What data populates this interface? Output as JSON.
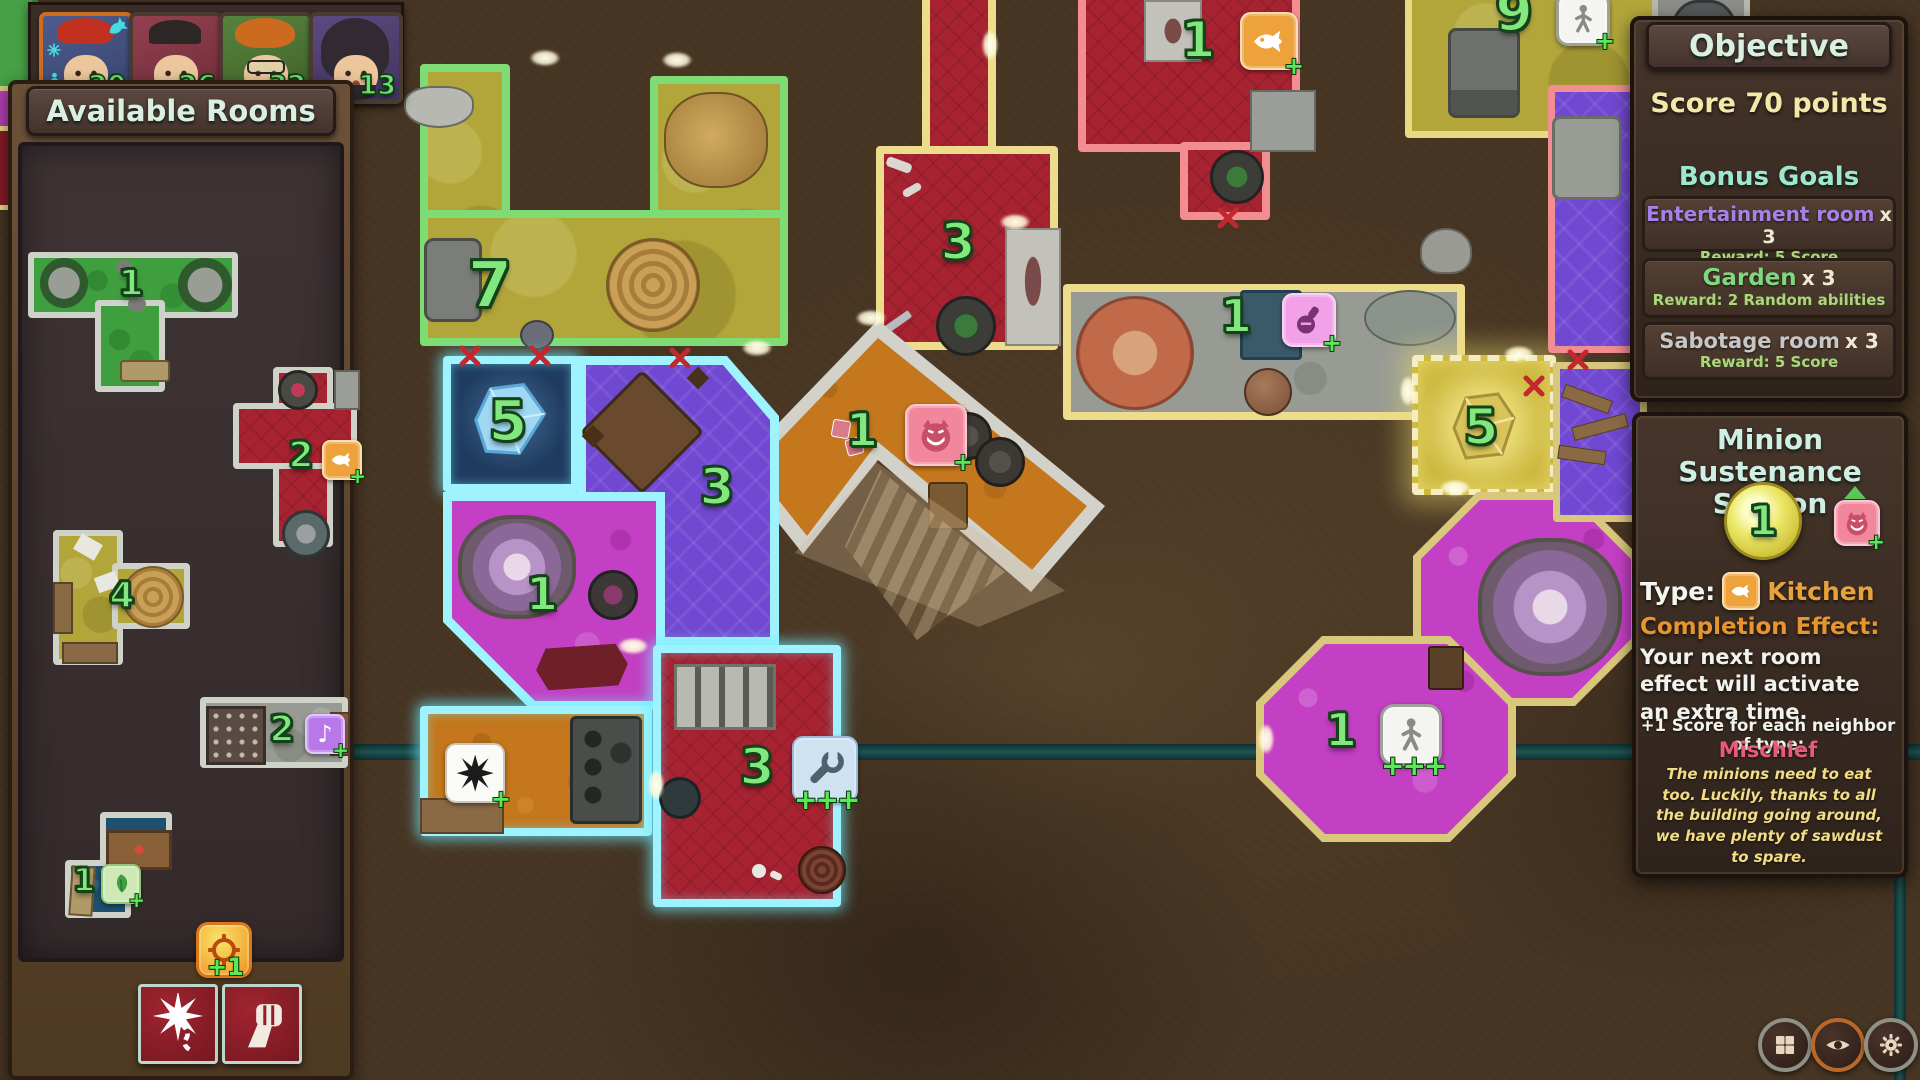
{
  "players": {
    "items": [
      {
        "name": "Player 1",
        "score": "20",
        "active": true
      },
      {
        "name": "Player 2",
        "score": "26",
        "active": false
      },
      {
        "name": "Player 3",
        "score": "32",
        "active": false
      },
      {
        "name": "Player 4",
        "score": "13",
        "active": false
      }
    ]
  },
  "sidebar": {
    "title": "Available Rooms",
    "rooms": {
      "garden_t": {
        "number": "1",
        "type": "garden"
      },
      "kitchen_plus": {
        "number": "2",
        "type": "kitchen"
      },
      "gallery_l": {
        "number": "4",
        "type": "gallery"
      },
      "entertainment_bar": {
        "number": "2",
        "type": "entertainment"
      },
      "garden_z": {
        "number": "1",
        "type": "garden"
      }
    },
    "ability_badge": "+1",
    "action_buttons": [
      {
        "name": "bomb"
      },
      {
        "name": "fist"
      }
    ]
  },
  "board": {
    "rooms": {
      "garden_hall": {
        "number": "7"
      },
      "crypt": {
        "number": "3"
      },
      "kitchen": {
        "number": "1"
      },
      "alchemy": {
        "number": "1"
      },
      "mischief": {
        "number": "1"
      },
      "vault": {
        "number": "5"
      },
      "dining": {
        "number": "3"
      },
      "geode": {
        "number": "1"
      },
      "workshop": {
        "number": "3",
        "bonus": "+++"
      },
      "gold_cell": {
        "number": "5"
      },
      "dormitory": {
        "number": "1",
        "bonus": "+++"
      },
      "barracks": {
        "number": "9"
      }
    }
  },
  "objective": {
    "title": "Objective",
    "goal": "Score 70 points",
    "bonus_title": "Bonus Goals",
    "goals": [
      {
        "name": "Entertainment room",
        "count": "x 3",
        "reward": "Reward: 5 Score",
        "color": "#a97fe8"
      },
      {
        "name": "Garden",
        "count": "x 3",
        "reward": "Reward: 2 Random abilities",
        "color": "#7fd87f"
      },
      {
        "name": "Sabotage room",
        "count": "x 3",
        "reward": "Reward: 5 Score",
        "color": "#c6c6c6"
      }
    ]
  },
  "room_info": {
    "title_line1": "Minion Sustenance",
    "title_line2": "Station",
    "score": "1",
    "type_label": "Type:",
    "type_value": "Kitchen",
    "effect_label": "Completion Effect:",
    "effect_text": "Your next room effect will activate an extra time.",
    "neighbor_text": "+1 Score for each neighbor of type:",
    "neighbor_type": "Mischief",
    "flavor": "The minions need to eat too. Luckily, thanks to all the building going around, we have plenty of sawdust to spare."
  },
  "symbols": {
    "plus": "+",
    "triple_plus": "+++"
  },
  "colors": {
    "accent_green_number": "#82e87e",
    "cyan_highlight": "#9ff3ff",
    "objective_title": "#cfeee4",
    "goal_text": "#f2e8a8",
    "reward_text": "#a8d87a",
    "mischief_text": "#e85a78",
    "kitchen_text": "#e8a23a",
    "flavor_text": "#f2dc84"
  }
}
